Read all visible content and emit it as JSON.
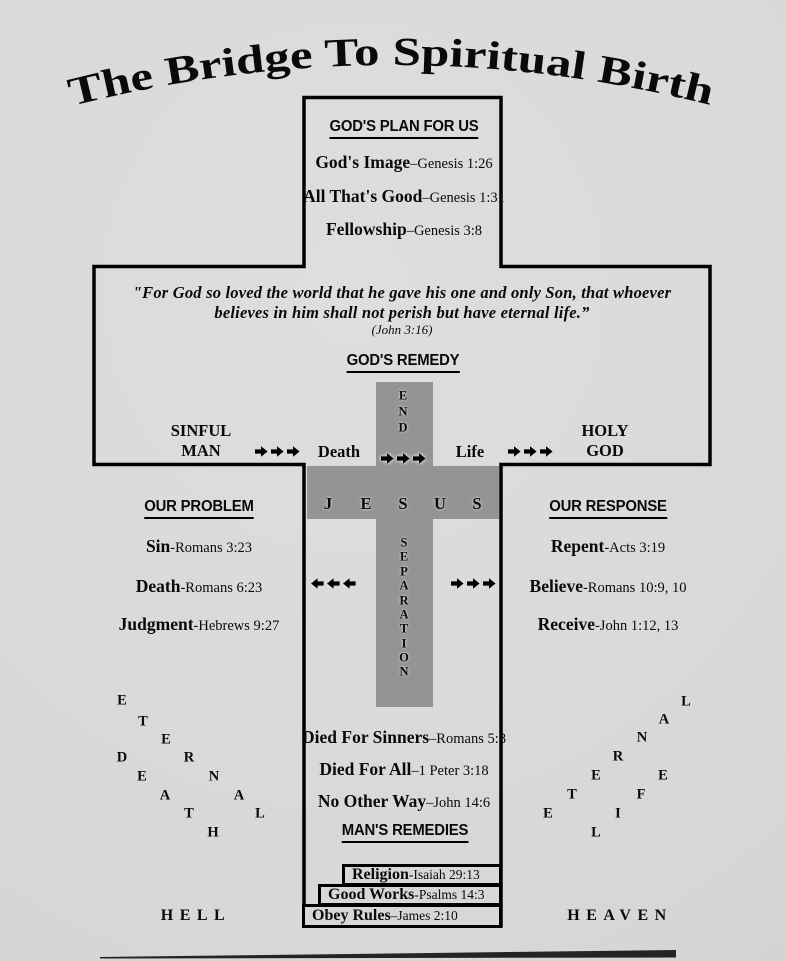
{
  "title": "The Bridge To Spiritual Birth",
  "colors": {
    "background": "#d7d7d7",
    "cross_gray": "#949494",
    "outline": "#000000"
  },
  "gods_plan": {
    "heading": "GOD'S PLAN FOR US",
    "items": [
      {
        "label": "God's Image",
        "ref": "–Genesis 1:26"
      },
      {
        "label": "All That's Good",
        "ref": "–Genesis 1:31"
      },
      {
        "label": "Fellowship",
        "ref": "–Genesis 3:8"
      }
    ]
  },
  "gods_remedy": {
    "quote_line1": "\"For God so loved the world that he gave his one and only Son, that whoever",
    "quote_line2": "believes in him shall not perish but have eternal life.”",
    "quote_citation": "(John 3:16)",
    "heading": "GOD'S REMEDY"
  },
  "bridge": {
    "sinful": "SINFUL",
    "man": "MAN",
    "death": "Death",
    "life": "Life",
    "holy": "HOLY",
    "god": "GOD",
    "end_letters": [
      {
        "ch": "E",
        "x": 403,
        "y": 396
      },
      {
        "ch": "N",
        "x": 403,
        "y": 412
      },
      {
        "ch": "D",
        "x": 403,
        "y": 428
      }
    ],
    "jesus_letters": [
      {
        "ch": "J",
        "x": 328,
        "y": 504
      },
      {
        "ch": "E",
        "x": 366,
        "y": 504
      },
      {
        "ch": "S",
        "x": 403,
        "y": 504
      },
      {
        "ch": "U",
        "x": 440,
        "y": 504
      },
      {
        "ch": "S",
        "x": 477,
        "y": 504
      }
    ],
    "separation_letters": [
      {
        "ch": "S",
        "x": 404,
        "y": 543
      },
      {
        "ch": "E",
        "x": 404,
        "y": 557
      },
      {
        "ch": "P",
        "x": 404,
        "y": 572
      },
      {
        "ch": "A",
        "x": 404,
        "y": 586
      },
      {
        "ch": "R",
        "x": 404,
        "y": 601
      },
      {
        "ch": "A",
        "x": 404,
        "y": 615
      },
      {
        "ch": "T",
        "x": 404,
        "y": 629
      },
      {
        "ch": "I",
        "x": 404,
        "y": 644
      },
      {
        "ch": "O",
        "x": 404,
        "y": 658
      },
      {
        "ch": "N",
        "x": 404,
        "y": 672
      }
    ]
  },
  "our_problem": {
    "heading": "OUR PROBLEM",
    "items": [
      {
        "label": "Sin",
        "ref": "-Romans 3:23"
      },
      {
        "label": "Death",
        "ref": "-Romans 6:23"
      },
      {
        "label": "Judgment",
        "ref": "-Hebrews 9:27"
      }
    ]
  },
  "our_response": {
    "heading": "OUR RESPONSE",
    "items": [
      {
        "label": "Repent",
        "ref": "-Acts 3:19"
      },
      {
        "label": "Believe",
        "ref": "-Romans 10:9, 10"
      },
      {
        "label": "Receive",
        "ref": "-John 1:12, 13"
      }
    ]
  },
  "provision": {
    "items": [
      {
        "label": "Died For Sinners",
        "ref": "–Romans 5:8"
      },
      {
        "label": "Died For All",
        "ref": "–1 Peter 3:18"
      },
      {
        "label": "No Other Way",
        "ref": "–John 14:6"
      }
    ]
  },
  "mans_remedies": {
    "heading": "MAN'S REMEDIES",
    "boxes": [
      {
        "label": "Religion",
        "ref": "-Isaiah 29:13"
      },
      {
        "label": "Good Works",
        "ref": "-Psalms 14:3"
      },
      {
        "label": "Obey Rules",
        "ref": "–James 2:10"
      }
    ]
  },
  "eternal_death_letters": [
    {
      "ch": "E",
      "x": 122,
      "y": 701
    },
    {
      "ch": "T",
      "x": 143,
      "y": 722
    },
    {
      "ch": "E",
      "x": 166,
      "y": 740
    },
    {
      "ch": "R",
      "x": 189,
      "y": 758
    },
    {
      "ch": "N",
      "x": 214,
      "y": 777
    },
    {
      "ch": "A",
      "x": 239,
      "y": 796
    },
    {
      "ch": "L",
      "x": 260,
      "y": 814
    },
    {
      "ch": "D",
      "x": 122,
      "y": 758
    },
    {
      "ch": "E",
      "x": 142,
      "y": 777
    },
    {
      "ch": "A",
      "x": 165,
      "y": 796
    },
    {
      "ch": "T",
      "x": 189,
      "y": 814
    },
    {
      "ch": "H",
      "x": 213,
      "y": 833
    }
  ],
  "eternal_life_letters": [
    {
      "ch": "L",
      "x": 686,
      "y": 702
    },
    {
      "ch": "A",
      "x": 664,
      "y": 720
    },
    {
      "ch": "N",
      "x": 642,
      "y": 738
    },
    {
      "ch": "R",
      "x": 618,
      "y": 757
    },
    {
      "ch": "E",
      "x": 596,
      "y": 776
    },
    {
      "ch": "T",
      "x": 572,
      "y": 795
    },
    {
      "ch": "E",
      "x": 548,
      "y": 814
    },
    {
      "ch": "E",
      "x": 663,
      "y": 776
    },
    {
      "ch": "F",
      "x": 641,
      "y": 795
    },
    {
      "ch": "I",
      "x": 618,
      "y": 814
    },
    {
      "ch": "L",
      "x": 596,
      "y": 833
    }
  ],
  "destinations": {
    "hell": "HELL",
    "heaven": "HEAVEN"
  }
}
